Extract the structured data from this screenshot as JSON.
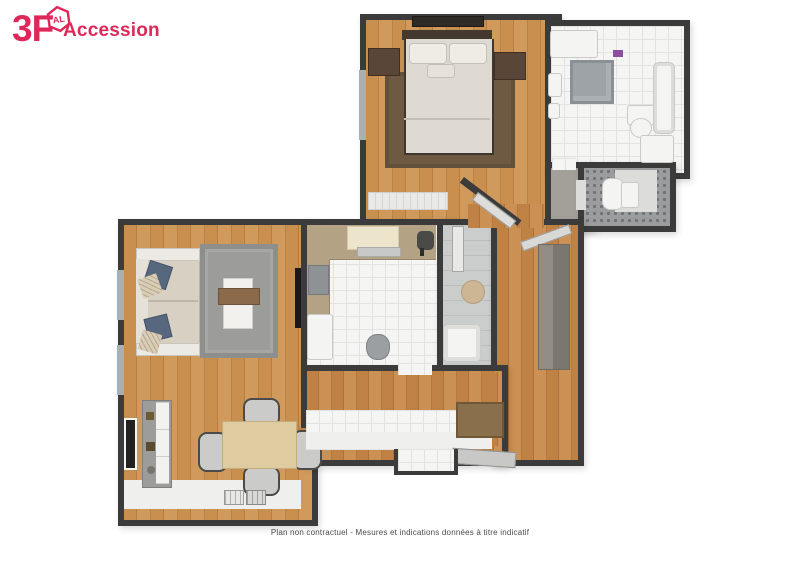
{
  "brand": {
    "text_3f": "3F",
    "badge_text": "AL",
    "text_accession": "Accession"
  },
  "caption": "Plan non contractuel - Mesures et indications données à titre indicatif",
  "palette": {
    "brand": "#DE2859",
    "wall": "#3B3B3B",
    "wallface": "#EFEFED",
    "wood": "#C98F4F",
    "tile": "#F5F5F3",
    "tileLine": "#E2E2E0",
    "grayFloor": "#CBCDCD",
    "rugBedroom": "#6E5A42",
    "rugLiving": "#9C9C9A",
    "sofa": "#D7D0C3",
    "bed": "#DEDAD2",
    "headboard": "#43392E",
    "nightstand": "#5A4636",
    "counter": "#B3A284",
    "cabinetCream": "#EDE4CC",
    "wardrobe": "#918C84",
    "doormat": "#8A6F4D",
    "table": "#DFCBA0",
    "chair": "#CBCBC9",
    "fixtureWhite": "#F4F4F2",
    "shower": "#9EA3A7",
    "towel": "#8C4E9E",
    "captionColor": "#4A4A4A"
  }
}
